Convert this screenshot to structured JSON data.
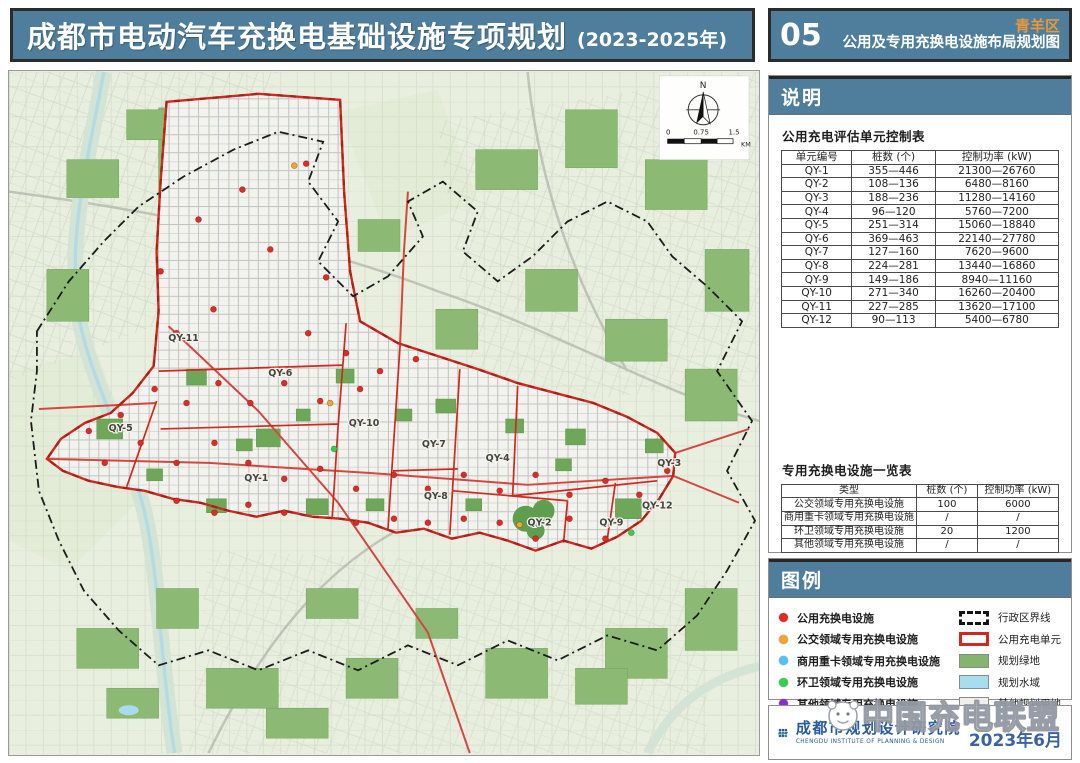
{
  "header": {
    "title": "成都市电动汽车充换电基础设施专项规划",
    "title_suffix": "(2023-2025年)",
    "sheet_no": "05",
    "district": "青羊区",
    "sheet_name": "公用及专用充换电设施布局规划图"
  },
  "notes_panel": {
    "title": "说明",
    "table1": {
      "title": "公用充电评估单元控制表",
      "headers": [
        "单元编号",
        "桩数 (个)",
        "控制功率 (kW)"
      ],
      "rows": [
        [
          "QY-1",
          "355—446",
          "21300—26760"
        ],
        [
          "QY-2",
          "108—136",
          "6480—8160"
        ],
        [
          "QY-3",
          "188—236",
          "11280—14160"
        ],
        [
          "QY-4",
          "96—120",
          "5760—7200"
        ],
        [
          "QY-5",
          "251—314",
          "15060—18840"
        ],
        [
          "QY-6",
          "369—463",
          "22140—27780"
        ],
        [
          "QY-7",
          "127—160",
          "7620—9600"
        ],
        [
          "QY-8",
          "224—281",
          "13440—16860"
        ],
        [
          "QY-9",
          "149—186",
          "8940—11160"
        ],
        [
          "QY-10",
          "271—340",
          "16260—20400"
        ],
        [
          "QY-11",
          "227—285",
          "13620—17100"
        ],
        [
          "QY-12",
          "90—113",
          "5400—6780"
        ]
      ]
    },
    "table2": {
      "title": "专用充换电设施一览表",
      "headers": [
        "类型",
        "桩数 (个)",
        "控制功率 (kW)"
      ],
      "rows": [
        [
          "公交领域专用充换电设施",
          "100",
          "6000"
        ],
        [
          "商用重卡领域专用充换电设施",
          "/",
          "/"
        ],
        [
          "环卫领域专用充换电设施",
          "20",
          "1200"
        ],
        [
          "其他领域专用充换电设施",
          "/",
          "/"
        ]
      ]
    }
  },
  "legend_panel": {
    "title": "图例",
    "point_items": [
      {
        "label": "公用充换电设施",
        "color": "#e02a22"
      },
      {
        "label": "公交领域专用充换电设施",
        "color": "#f2a52e"
      },
      {
        "label": "商用重卡领域专用充换电设施",
        "color": "#4fc3f7"
      },
      {
        "label": "环卫领域专用充换电设施",
        "color": "#2fd24a"
      },
      {
        "label": "其他领域专用充换电设施",
        "color": "#8e2bd4"
      }
    ],
    "area_items": [
      {
        "label": "行政区界线",
        "style": "admin"
      },
      {
        "label": "公用充电单元",
        "style": "unit",
        "color": "#d3271f"
      },
      {
        "label": "规划绿地",
        "style": "fill",
        "color": "#84b56d"
      },
      {
        "label": "规划水域",
        "style": "fill",
        "color": "#a8ddf0"
      },
      {
        "label": "其他规划用地",
        "style": "fill",
        "color": "#efefec"
      }
    ]
  },
  "footer": {
    "institute_cn": "成都市规划设计研究院",
    "institute_en": "CHENGDU INSTITUTE OF PLANNING & DESIGN",
    "date": "2023年6月",
    "watermark": "中国充电联盟"
  },
  "map": {
    "north_label": "N",
    "scale": {
      "ticks": [
        "0",
        "0.75",
        "1.5"
      ],
      "unit": "KM"
    },
    "unit_labels": [
      {
        "id": "QY-11",
        "x": 175,
        "y": 270
      },
      {
        "id": "QY-5",
        "x": 112,
        "y": 360
      },
      {
        "id": "QY-6",
        "x": 272,
        "y": 305
      },
      {
        "id": "QY-1",
        "x": 248,
        "y": 410
      },
      {
        "id": "QY-10",
        "x": 356,
        "y": 355
      },
      {
        "id": "QY-7",
        "x": 426,
        "y": 376
      },
      {
        "id": "QY-4",
        "x": 490,
        "y": 390
      },
      {
        "id": "QY-8",
        "x": 428,
        "y": 428
      },
      {
        "id": "QY-2",
        "x": 532,
        "y": 455
      },
      {
        "id": "QY-9",
        "x": 604,
        "y": 455
      },
      {
        "id": "QY-3",
        "x": 662,
        "y": 395
      },
      {
        "id": "QY-12",
        "x": 650,
        "y": 438
      }
    ],
    "facilities": [
      {
        "type": "public",
        "color": "#e02a22",
        "points": [
          [
            168,
            262
          ],
          [
            205,
            238
          ],
          [
            152,
            200
          ],
          [
            190,
            148
          ],
          [
            234,
            118
          ],
          [
            298,
            92
          ],
          [
            262,
            178
          ],
          [
            318,
            206
          ],
          [
            300,
            262
          ],
          [
            338,
            282
          ],
          [
            372,
            300
          ],
          [
            408,
            288
          ],
          [
            352,
            318
          ],
          [
            312,
            330
          ],
          [
            276,
            312
          ],
          [
            242,
            332
          ],
          [
            210,
            312
          ],
          [
            178,
            332
          ],
          [
            146,
            318
          ],
          [
            112,
            344
          ],
          [
            80,
            360
          ],
          [
            96,
            392
          ],
          [
            132,
            372
          ],
          [
            168,
            392
          ],
          [
            206,
            372
          ],
          [
            240,
            392
          ],
          [
            276,
            408
          ],
          [
            312,
            398
          ],
          [
            348,
            418
          ],
          [
            386,
            404
          ],
          [
            420,
            418
          ],
          [
            456,
            404
          ],
          [
            492,
            420
          ],
          [
            528,
            404
          ],
          [
            562,
            424
          ],
          [
            598,
            410
          ],
          [
            632,
            424
          ],
          [
            660,
            400
          ],
          [
            598,
            468
          ],
          [
            562,
            448
          ],
          [
            528,
            468
          ],
          [
            492,
            452
          ],
          [
            456,
            448
          ],
          [
            420,
            452
          ],
          [
            386,
            448
          ],
          [
            348,
            452
          ],
          [
            276,
            442
          ],
          [
            240,
            434
          ],
          [
            206,
            442
          ],
          [
            168,
            430
          ]
        ]
      },
      {
        "type": "bus",
        "color": "#f2a52e",
        "points": [
          [
            322,
            332
          ],
          [
            512,
            454
          ],
          [
            286,
            94
          ]
        ]
      },
      {
        "type": "sanitation",
        "color": "#2fd24a",
        "points": [
          [
            326,
            378
          ],
          [
            624,
            462
          ]
        ]
      }
    ]
  }
}
